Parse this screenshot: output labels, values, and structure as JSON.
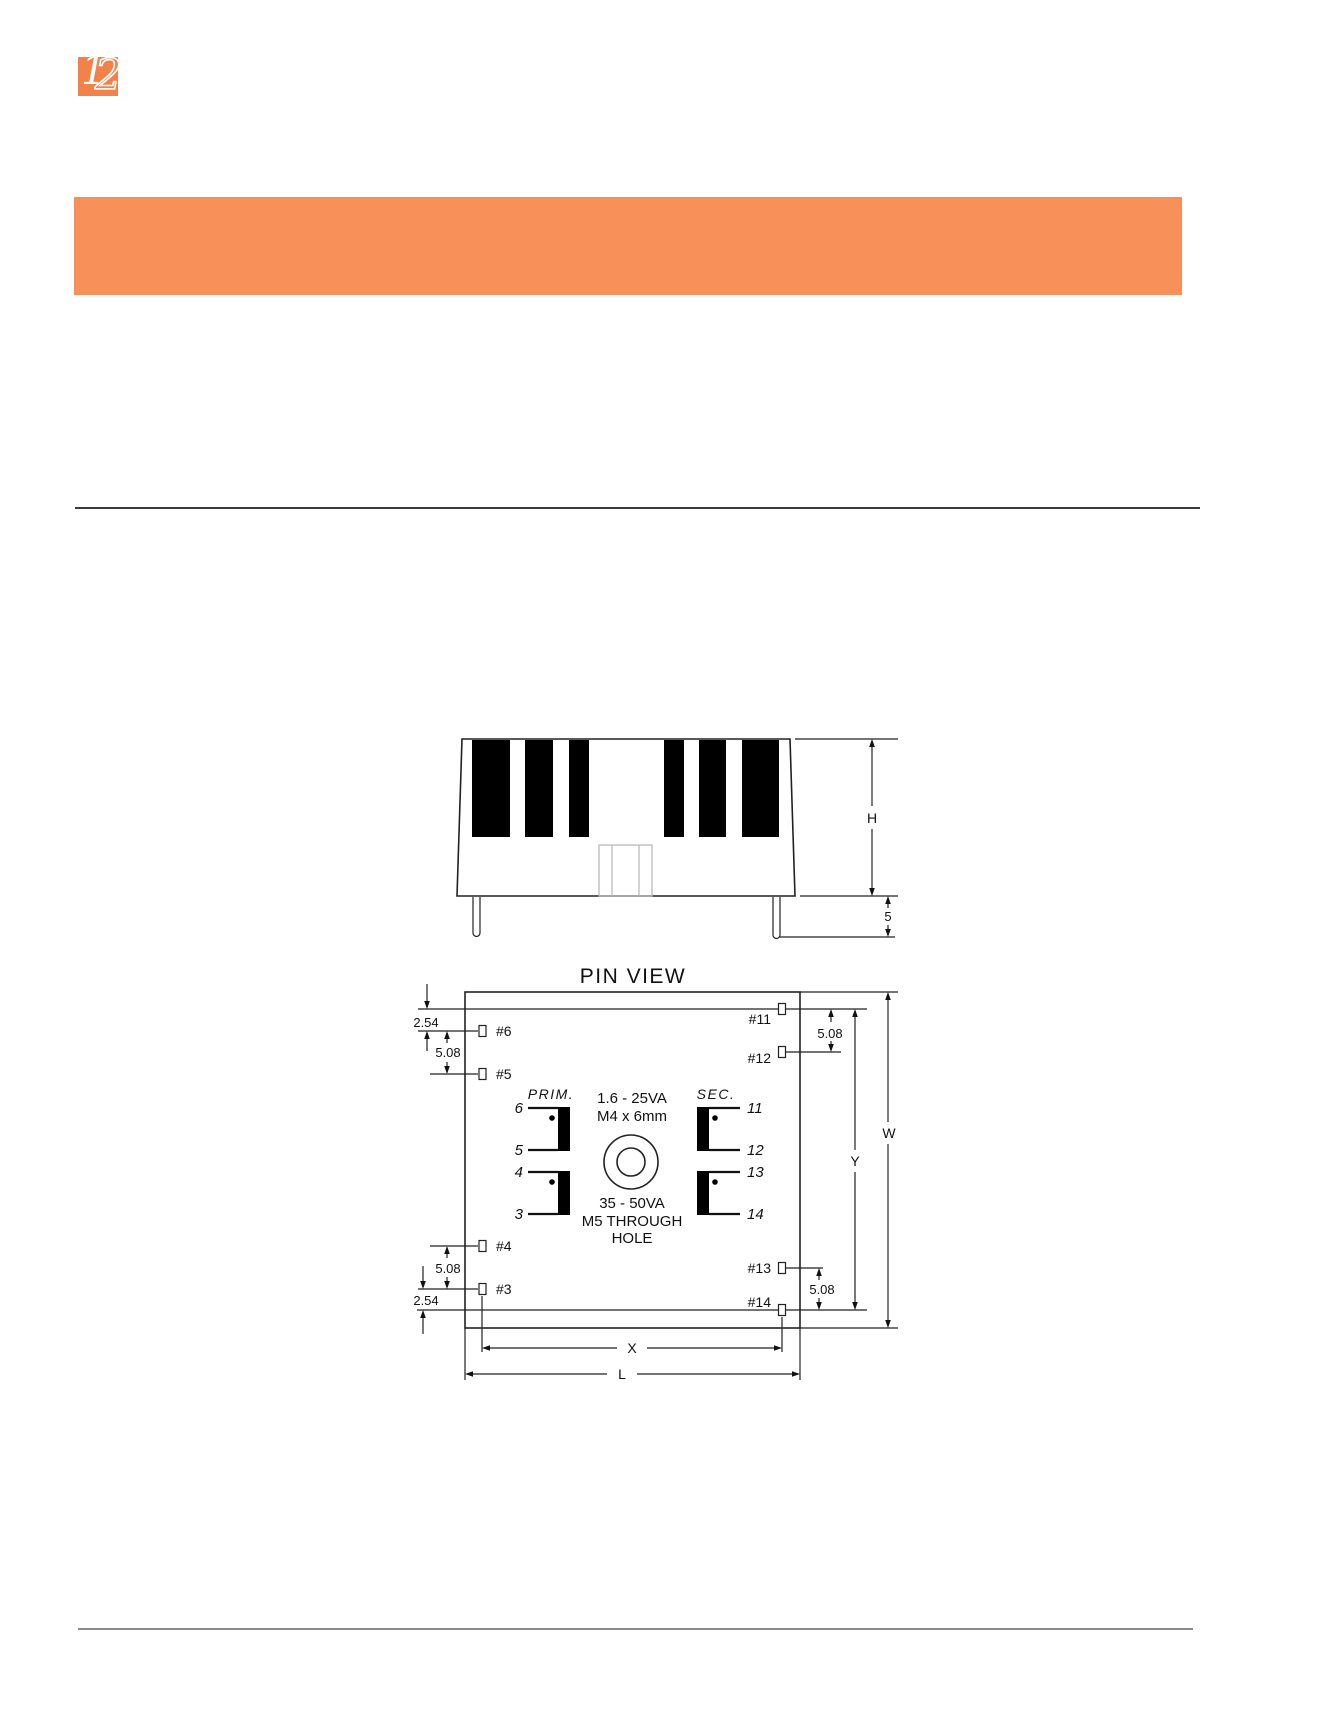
{
  "brand": {
    "logo_digit_1": "1",
    "logo_digit_2": "2",
    "accent_color": "#f8905a"
  },
  "side_view": {
    "dim_height": "H",
    "dim_pin_length": "5"
  },
  "pin_view": {
    "title": "PIN VIEW",
    "pads": {
      "p6": "#6",
      "p5": "#5",
      "p4": "#4",
      "p3": "#3",
      "p11": "#11",
      "p12": "#12",
      "p13": "#13",
      "p14": "#14"
    },
    "dims": {
      "pitch_small": "2.54",
      "pitch_large": "5.08",
      "width": "W",
      "pin_span_y": "Y",
      "pin_span_x": "X",
      "length": "L"
    },
    "schematic": {
      "primary_label": "PRIM.",
      "secondary_label": "SEC.",
      "primary_pins": [
        "6",
        "5",
        "4",
        "3"
      ],
      "secondary_pins": [
        "11",
        "12",
        "13",
        "14"
      ],
      "mount_note_small_va": "1.6 - 25VA",
      "mount_note_small_screw": "M4 x 6mm",
      "mount_note_large_va": "35 - 50VA",
      "mount_note_large_line2": "M5 THROUGH",
      "mount_note_large_line3": "HOLE"
    }
  }
}
